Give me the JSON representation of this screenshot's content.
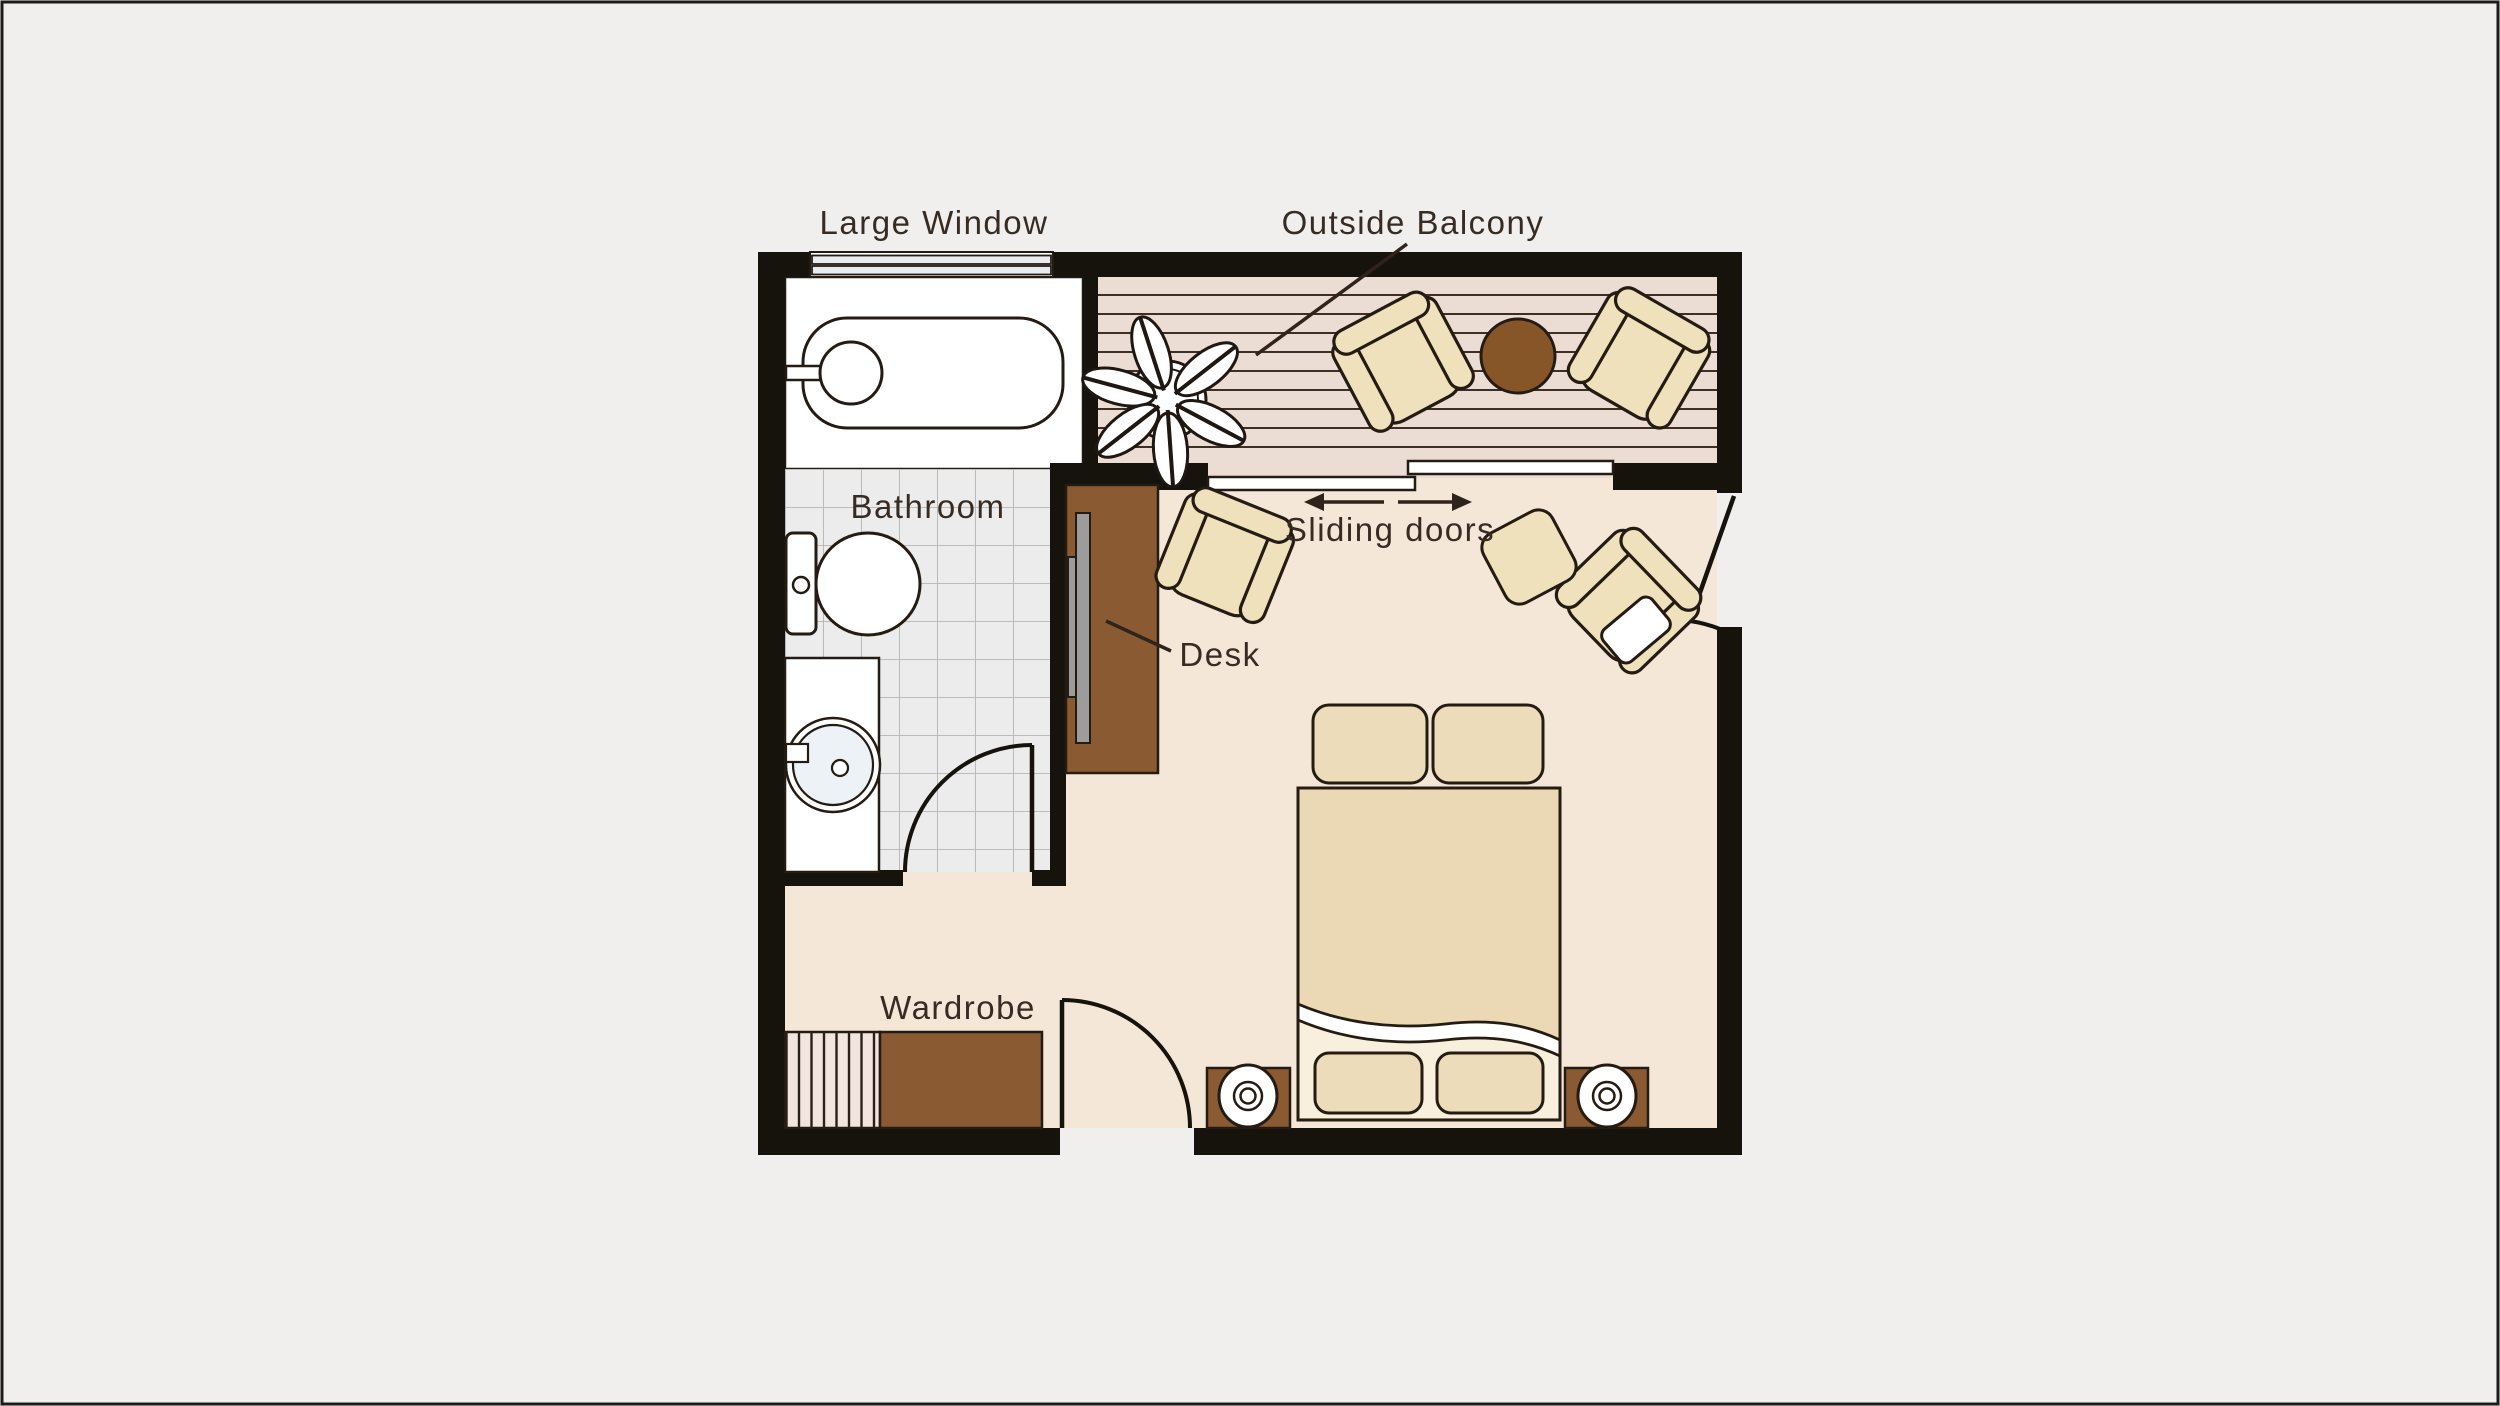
{
  "title": "Studio room floor plan",
  "labels": {
    "large_window": "Large Window",
    "outside_balcony": "Outside Balcony",
    "bathroom": "Bathroom",
    "sliding_doors": "Sliding doors",
    "desk": "Desk",
    "wardrobe": "Wardrobe"
  },
  "rooms": [
    "Bathroom",
    "Outside Balcony",
    "Main room"
  ],
  "features": [
    "Large Window",
    "Sliding doors",
    "Desk",
    "Wardrobe",
    "Bed",
    "Bathtub",
    "Toilet",
    "Sink",
    "Plant",
    "Balcony chairs",
    "Balcony table",
    "Armchairs",
    "Side table",
    "Nightstands",
    "Lamps"
  ],
  "colors": {
    "background": "#f0efee",
    "wall": "#16120c",
    "floor_main": "#f4e7d7",
    "floor_deck": "#ecddd4",
    "deck_line": "#3d2f24",
    "tile_fill": "#ececec",
    "tile_line": "#b5b5b5",
    "furniture_tan": "#f0e1bd",
    "bed_tan": "#ead9b4",
    "sheet_light": "#f8efdc",
    "wood_brown": "#8a5a33",
    "table_brown": "#875628",
    "monitor_gray": "#9c9c9c",
    "outline": "#241b12",
    "label_text": "#372c23"
  }
}
